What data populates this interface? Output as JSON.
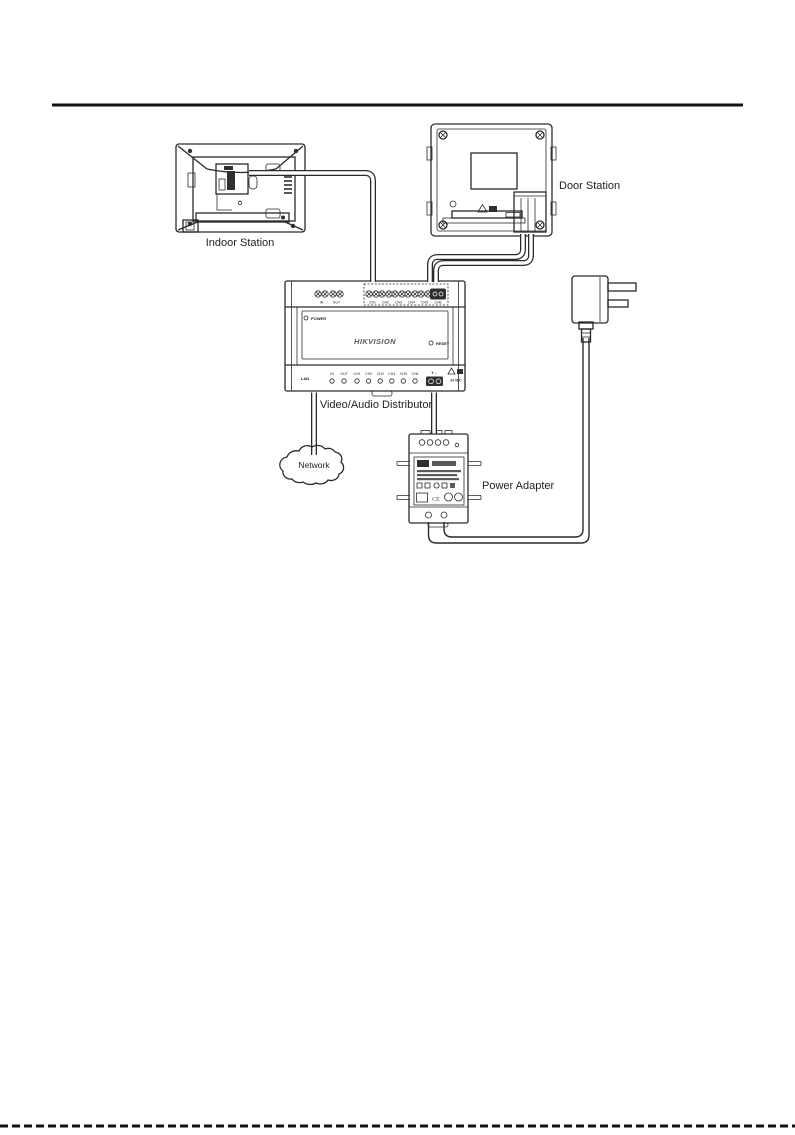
{
  "colors": {
    "line": "#2a2a2a",
    "text": "#1f1f1f",
    "background": "#ffffff",
    "logo": "#5a5a5a"
  },
  "diagram": {
    "devices": {
      "indoor_station": {
        "label": "Indoor Station"
      },
      "door_station": {
        "label": "Door Station"
      },
      "distributor": {
        "label": "Video/Audio Distributor",
        "brand": "HIKVISION",
        "power_led": "POWER",
        "reset": "RESET",
        "in": "IN",
        "out": "OUT",
        "channels": [
          "CH1",
          "CH2",
          "CH3",
          "CH4",
          "CH5",
          "CH6"
        ],
        "lan": "LAN",
        "dc_terminal": "+ -",
        "dc_voltage": "24 VDC"
      },
      "network": {
        "label": "Network"
      },
      "power_adapter": {
        "label": "Power Adapter",
        "ce_mark": "CE"
      },
      "power_plug": {
        "label": ""
      }
    }
  }
}
